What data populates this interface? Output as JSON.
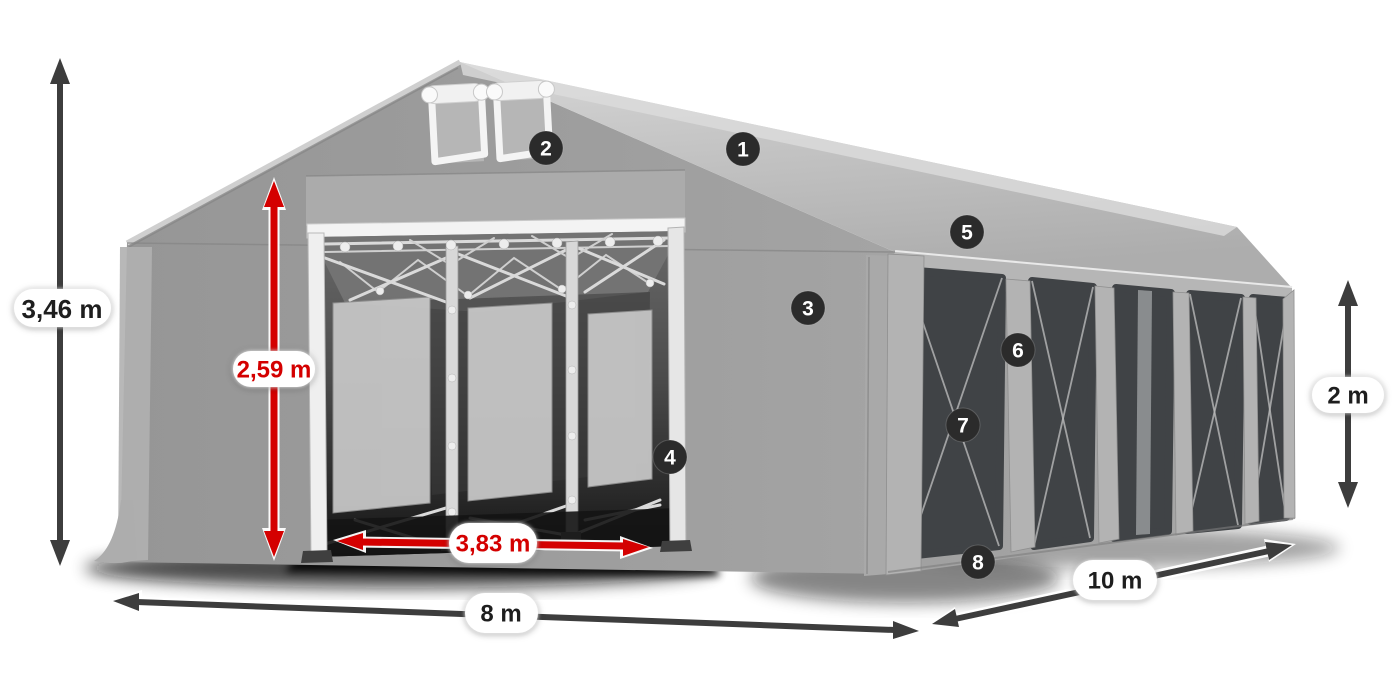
{
  "illustration": {
    "description": "Grey PVC marquee tent, open gable entrance with roll-up vent windows and five panoramic side windows",
    "badges": [
      "1",
      "2",
      "3",
      "4",
      "5",
      "6",
      "7",
      "8"
    ]
  },
  "dimensions": {
    "total_height": "3,46 m",
    "entrance_height": "2,59 m",
    "entrance_width": "3,83 m",
    "gable_width": "8 m",
    "side_length": "10 m",
    "side_height": "2 m"
  },
  "colors": {
    "accent_red": "#d40000",
    "arrow_dark": "#3d3d3d",
    "badge_bg": "#2b2b2b",
    "badge_text": "#ffffff",
    "pill_bg": "#ffffff",
    "dim_text": "#1e1e1e",
    "tent_roof": "#c3c3c3",
    "tent_front": "#9b9b9b",
    "tent_side": "#a3a3a3",
    "tent_valance": "#b6b6b6",
    "tent_pillar": "#b3b3b3",
    "window_dark": "#404346",
    "background": "#ffffff"
  }
}
